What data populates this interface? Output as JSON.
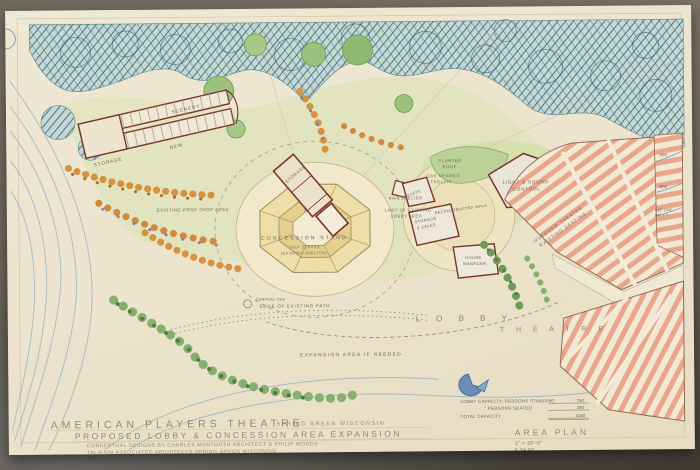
{
  "colors": {
    "sheet": "#ece4cd",
    "forest_hatch": "#46788a",
    "green_wash": "#d9e4b2",
    "contour_blue": "#8fafc8",
    "building_line": "#7a3530",
    "seating_pink": "#e9a68c",
    "annotation_text": "#6b665a"
  },
  "labels": {
    "existing_prop_shop": "EXISTING PROP SHOP AREA",
    "scenery": "SCENERY",
    "storage_wing": "STORAGE",
    "new_shop": "NEW",
    "storage_central": "STORAGE",
    "concession_stand": "CONCESSION STAND",
    "self_service": "SELF SERVICE",
    "existing_shelter": "(EXISTING SHELTER)",
    "limit_line1": "LIMIT OF EXISTING",
    "limit_line2": "LOBBY AREA",
    "planted1": "PLANTED",
    "planted2": "ROOF",
    "oak1": "OAK FRAMED",
    "oak2": "TRELLIS",
    "rain_shelter": "RAIN SHELTER",
    "light_sound1": "LIGHT & SOUND",
    "light_sound2": "CONTROL",
    "reconstructed_walk": "RECONSTRUCTED WALK",
    "storage_sales1": "STORAGE",
    "storage_sales2": "& SALES",
    "house_mgr1": "HOUSE",
    "house_mgr2": "MANAGER",
    "toilets": "TOILETS",
    "outdoor1": "OUTDOOR THEATRE",
    "outdoor2": "EXISTING SEATING",
    "lobby_spaced": "L O B B Y",
    "theatre_spaced": "T H E A T R E",
    "expansion": "EXPANSION AREA IF NEEDED",
    "edge_path": "EDGE OF EXISTING PATH",
    "central_oak": "CENTRAL OAK"
  },
  "elevations": {
    "e900": "900",
    "e895": "895",
    "ref_line1": "REF. LINE",
    "ref_line2": "890 + 0"
  },
  "capacity": {
    "row1_label": "LOBBY CAPACITY: PERSONS STANDING",
    "row1_value": "750",
    "row2_label": "”          PERSONS SEATED",
    "row2_value": "400",
    "row3_label": "TOTAL CAPACITY",
    "row3_value": "1150"
  },
  "plan_info": {
    "name": "AREA PLAN",
    "scale": "1\" = 20'-0\"",
    "date": "6.24.93"
  },
  "title_block": {
    "project": "AMERICAN PLAYERS THEATRE",
    "location": "SPRING GREEN WISCONSIN",
    "subtitle": "PROPOSED LOBBY & CONCESSION AREA EXPANSION",
    "credits": "CONCEPTUAL DESIGNS BY CHARLES MONTOOTH ARCHITECT & PHILIP WOODS",
    "firm": "TALIESIN ASSOCIATED ARCHITECTS    SPRING GREEN WISCONSIN"
  }
}
